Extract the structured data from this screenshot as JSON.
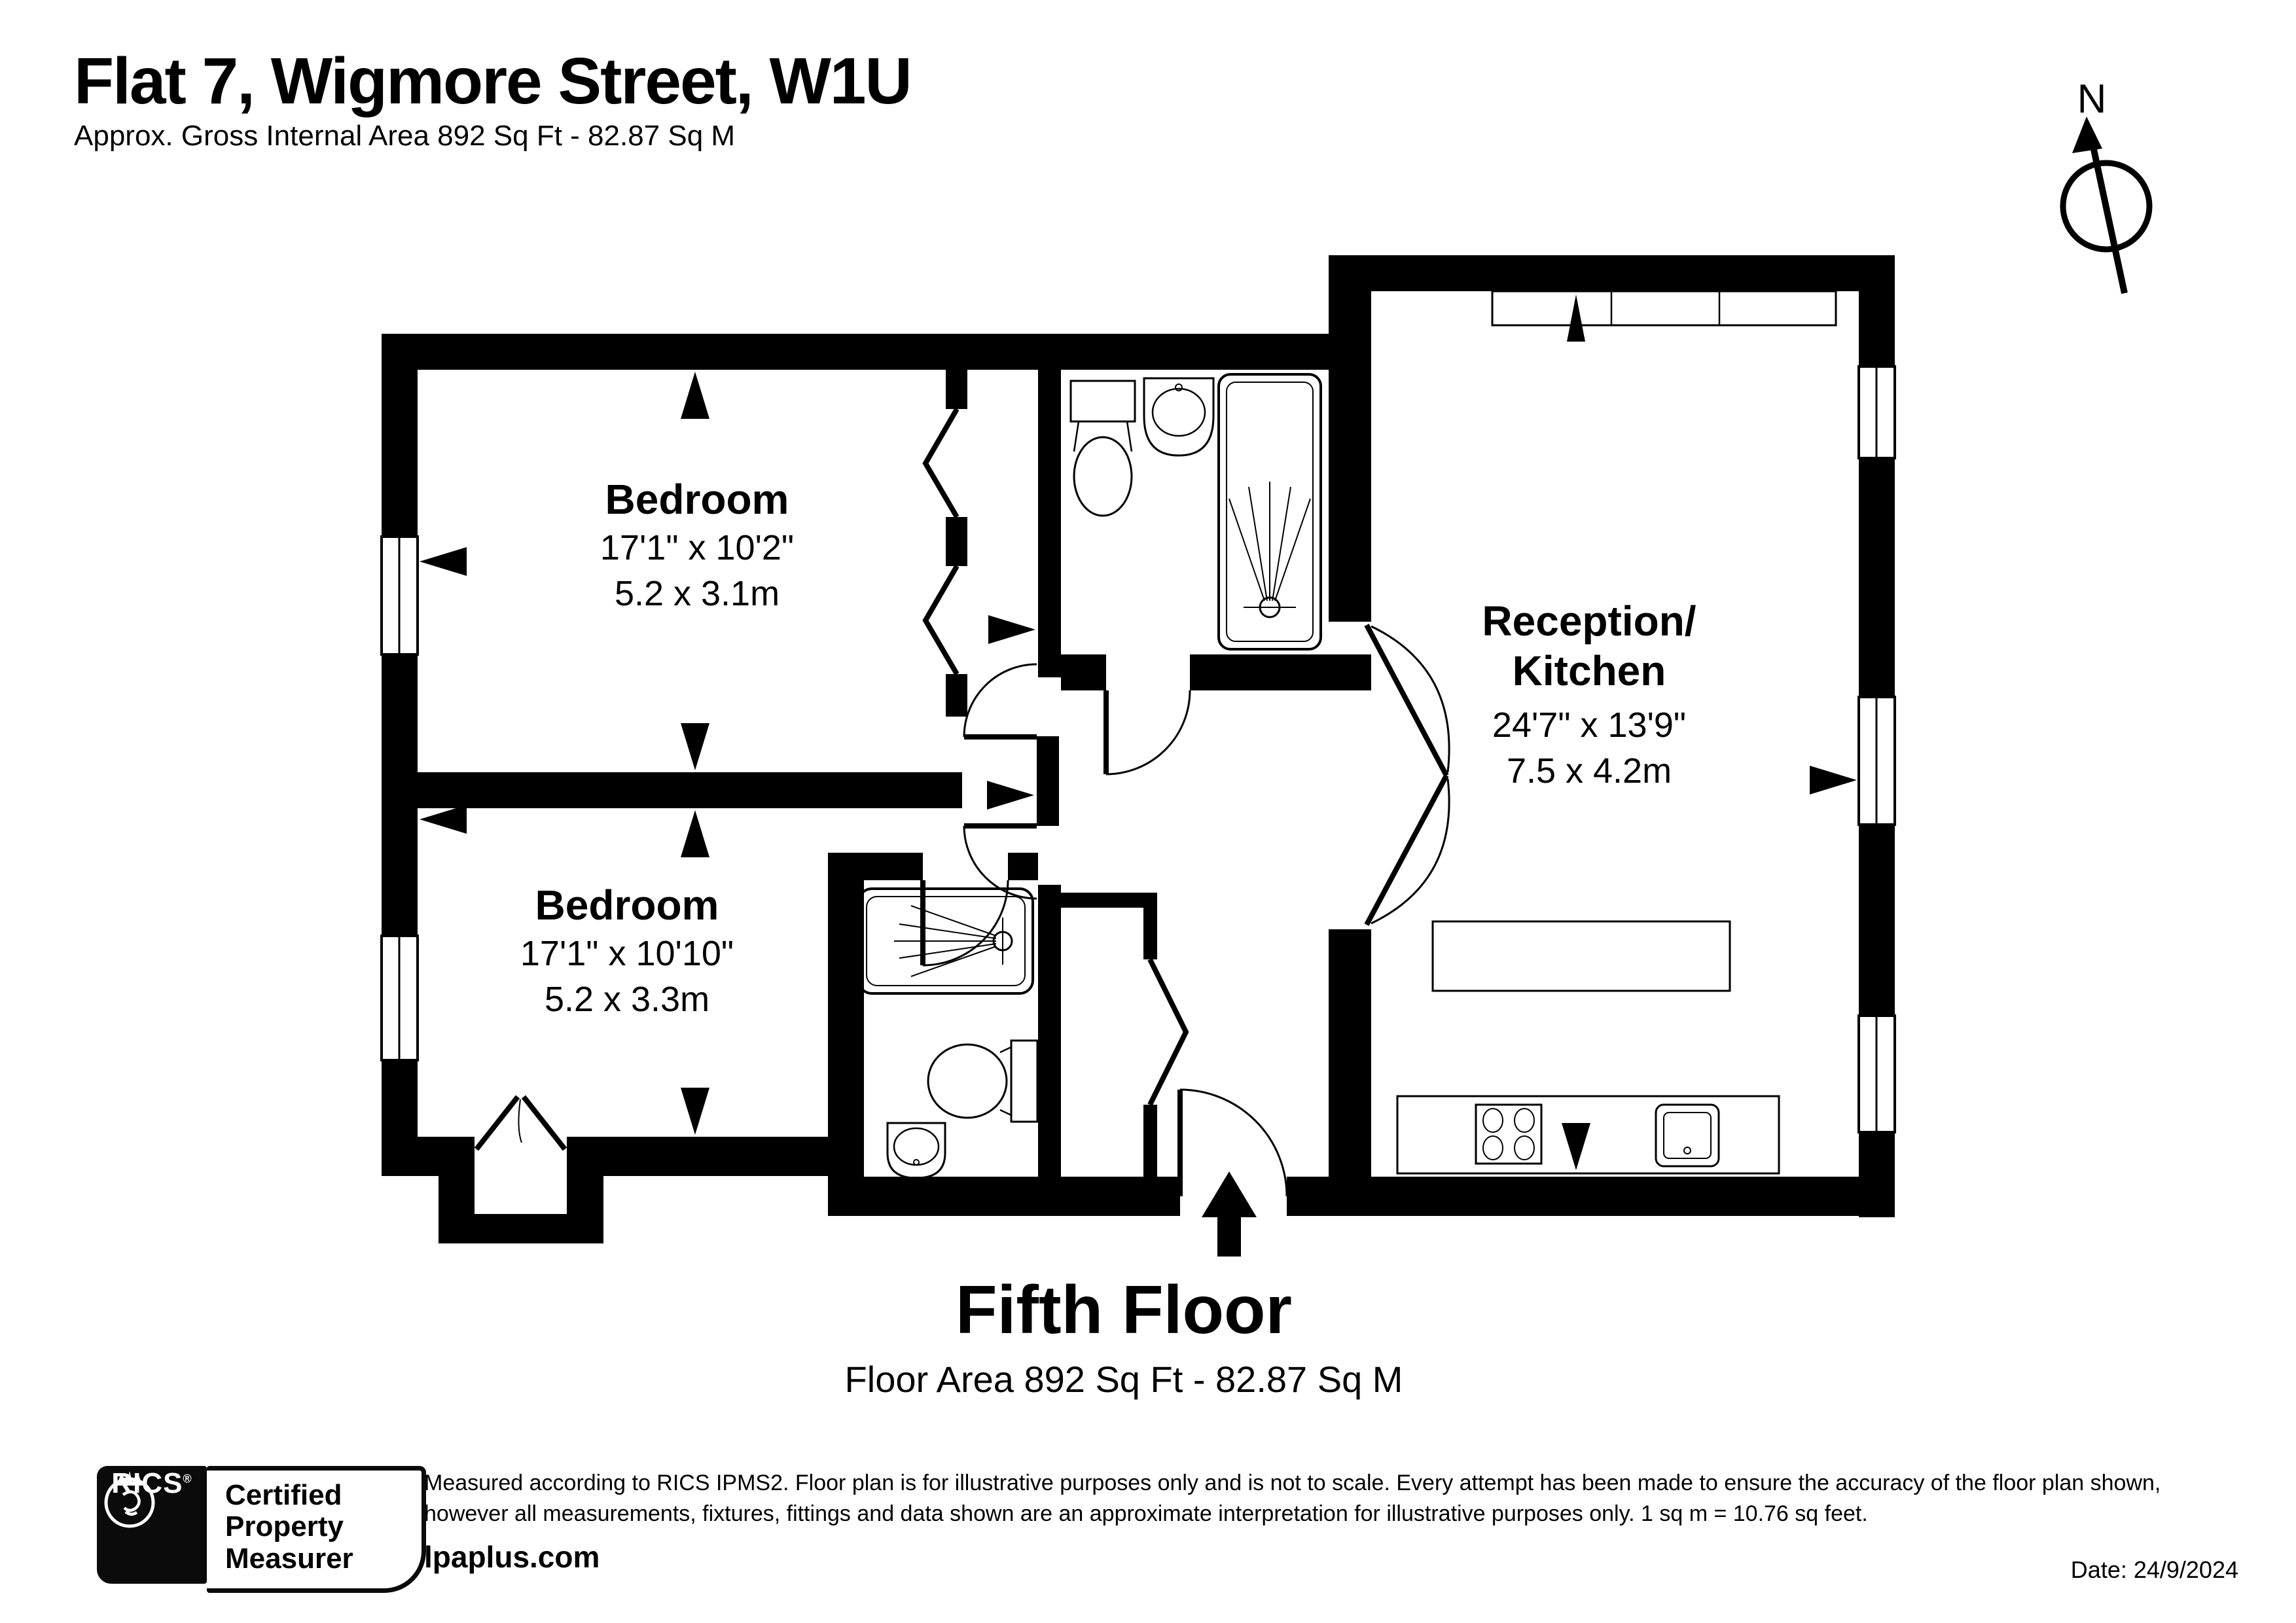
{
  "header": {
    "title": "Flat 7, Wigmore Street, W1U",
    "subtitle": "Approx. Gross Internal Area 892 Sq Ft - 82.87 Sq M"
  },
  "compass": {
    "label": "N"
  },
  "rooms": [
    {
      "name": "Bedroom",
      "dims_ft": "17'1\" x 10'2\"",
      "dims_m": "5.2 x 3.1m"
    },
    {
      "name": "Bedroom",
      "dims_ft": "17'1\" x 10'10\"",
      "dims_m": "5.2 x 3.3m"
    },
    {
      "name_line1": "Reception/",
      "name_line2": "Kitchen",
      "dims_ft": "24'7\" x 13'9\"",
      "dims_m": "7.5 x 4.2m"
    }
  ],
  "floor": {
    "title": "Fifth Floor",
    "area": "Floor Area 892 Sq Ft - 82.87 Sq M"
  },
  "footer": {
    "rics_label": "RICS",
    "registered_mark": "®",
    "cert_line1": "Certified",
    "cert_line2": "Property",
    "cert_line3": "Measurer",
    "disclaimer_line1": "Measured according to RICS IPMS2. Floor plan is for illustrative purposes only and is not to scale. Every attempt has been made to ensure the accuracy of the floor plan shown,",
    "disclaimer_line2": "however all measurements, fixtures, fittings and data shown are an approximate interpretation for illustrative purposes only. 1 sq m = 10.76 sq feet.",
    "brand": "lpaplus.com",
    "date": "Date: 24/9/2024"
  },
  "icons": {
    "compass_needle": "north-arrow-through-circle",
    "entrance_arrow": "solid-up-arrow",
    "rics_emblem": "lion-in-circle",
    "measurement_arrow": "solid-triangle"
  }
}
